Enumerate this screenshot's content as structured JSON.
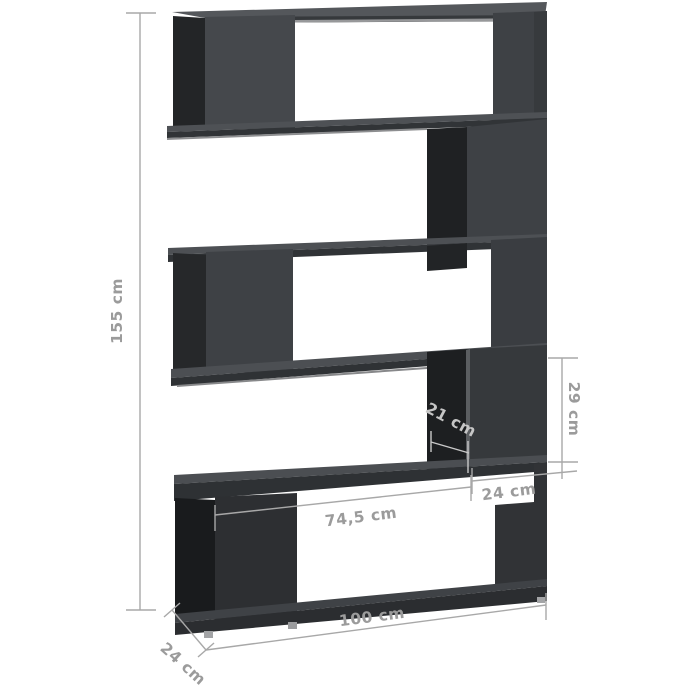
{
  "diagram": {
    "kind": "furniture-dimension-diagram",
    "subject": "5-tier zigzag bookcase room divider, high gloss gray",
    "unit": "cm",
    "dimensions": {
      "height": {
        "value": "155",
        "label": "155 cm"
      },
      "width": {
        "value": "100",
        "label": "100 cm"
      },
      "depth": {
        "value": "24",
        "label": "24 cm"
      },
      "inner_width": {
        "value": "74,5",
        "label": "74,5 cm"
      },
      "divider_depth": {
        "value": "21",
        "label": "21 cm"
      },
      "compartment_height": {
        "value": "29",
        "label": "29 cm"
      },
      "right_section_width": {
        "value": "24",
        "label": "24 cm"
      }
    },
    "colors": {
      "background": "#ffffff",
      "dimension_line": "#a8a8a8",
      "dimension_label": "#9b9b9b",
      "dimension_label_on_dark": "#c6c6c6",
      "panel_light": "#45484c",
      "panel_mid": "#3e4145",
      "panel_dark": "#2d2f32",
      "interior_shadow": "#1d1f21",
      "top_face": "#54575b",
      "feet": "#a3a4a6"
    }
  }
}
